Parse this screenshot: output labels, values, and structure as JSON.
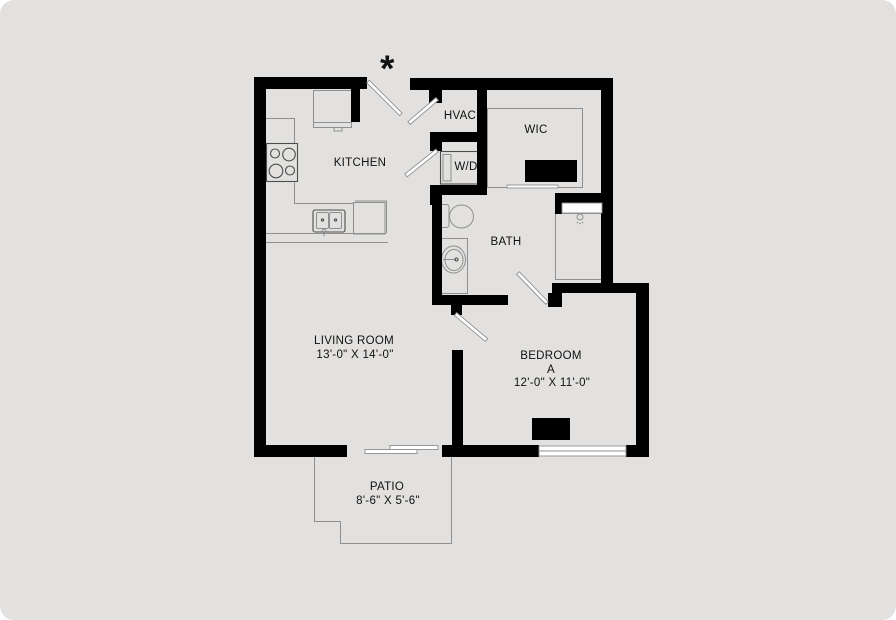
{
  "colors": {
    "page_bg": "#ffffff",
    "floor": "#e2e1df",
    "wall": "#000000",
    "line": "#8f8f8f",
    "dark": "#4d4d4d",
    "white": "#ffffff",
    "text": "#111111"
  },
  "annotation": {
    "asterisk": "*"
  },
  "rooms": {
    "kitchen": {
      "label": "KITCHEN"
    },
    "hvac": {
      "label": "HVAC"
    },
    "wic": {
      "label": "WIC"
    },
    "wd": {
      "label": "W/D"
    },
    "bath": {
      "label": "BATH"
    },
    "living": {
      "label": "LIVING ROOM",
      "dimensions": "13'-0\" X 14'-0\""
    },
    "bedroom": {
      "label": "BEDROOM",
      "unit": "A",
      "dimensions": "12'-0\" X 11'-0\""
    },
    "patio": {
      "label": "PATIO",
      "dimensions": "8'-6\" X 5'-6\""
    }
  }
}
